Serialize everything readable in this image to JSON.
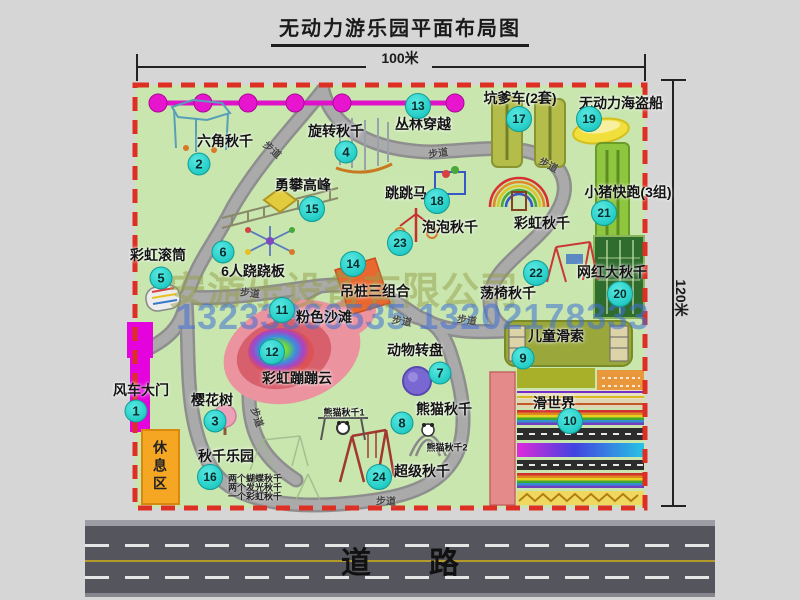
{
  "title": "无动力游乐园平面布局图",
  "dimensions": {
    "width_label": "100米",
    "height_label": "120米"
  },
  "road": {
    "label": "道路"
  },
  "watermark": {
    "company": "安游乐设备有限公司",
    "phone": "13233866535 13202178333"
  },
  "map": {
    "rest_area_label": "休息区",
    "path_label_text": "步道",
    "path_labels": [
      {
        "x": 273,
        "y": 149,
        "rot": 42
      },
      {
        "x": 438,
        "y": 152,
        "rot": -8
      },
      {
        "x": 549,
        "y": 164,
        "rot": 28
      },
      {
        "x": 250,
        "y": 292,
        "rot": 6
      },
      {
        "x": 402,
        "y": 320,
        "rot": 10
      },
      {
        "x": 467,
        "y": 319,
        "rot": 8
      },
      {
        "x": 258,
        "y": 417,
        "rot": 72
      },
      {
        "x": 386,
        "y": 500,
        "rot": 2
      }
    ],
    "attractions": [
      {
        "num": "1",
        "name": "风车大门",
        "badge": [
          136,
          411
        ],
        "label": [
          141,
          390
        ]
      },
      {
        "num": "2",
        "name": "六角秋千",
        "badge": [
          199,
          164
        ],
        "label": [
          225,
          141
        ]
      },
      {
        "num": "3",
        "name": "樱花树",
        "badge": [
          215,
          421
        ],
        "label": [
          212,
          400
        ]
      },
      {
        "num": "4",
        "name": "旋转秋千",
        "badge": [
          346,
          152
        ],
        "label": [
          336,
          131
        ]
      },
      {
        "num": "5",
        "name": "彩虹滚筒",
        "badge": [
          161,
          278
        ],
        "label": [
          158,
          255
        ]
      },
      {
        "num": "6",
        "name": "6人跷跷板",
        "badge": [
          223,
          252
        ],
        "label": [
          253,
          271
        ]
      },
      {
        "num": "7",
        "name": "动物转盘",
        "badge": [
          440,
          373
        ],
        "label": [
          415,
          350
        ]
      },
      {
        "num": "8",
        "name": "熊猫秋千",
        "badge": [
          402,
          423
        ],
        "label": [
          444,
          409
        ]
      },
      {
        "num": "9",
        "name": "儿童滑索",
        "badge": [
          523,
          358
        ],
        "label": [
          556,
          336
        ]
      },
      {
        "num": "10",
        "name": "滑世界",
        "badge": [
          570,
          421
        ],
        "label": [
          554,
          403
        ]
      },
      {
        "num": "11",
        "name": "粉色沙滩",
        "badge": [
          282,
          310
        ],
        "label": [
          324,
          317
        ]
      },
      {
        "num": "12",
        "name": "彩虹蹦蹦云",
        "badge": [
          272,
          352
        ],
        "label": [
          297,
          378
        ]
      },
      {
        "num": "13",
        "name": "丛林穿越",
        "badge": [
          418,
          106
        ],
        "label": [
          423,
          124
        ]
      },
      {
        "num": "14",
        "name": "吊桩三组合",
        "badge": [
          353,
          264
        ],
        "label": [
          375,
          291
        ]
      },
      {
        "num": "15",
        "name": "勇攀高峰",
        "badge": [
          312,
          209
        ],
        "label": [
          303,
          185
        ]
      },
      {
        "num": "16",
        "name": "秋千乐园",
        "badge": [
          210,
          477
        ],
        "label": [
          226,
          456
        ]
      },
      {
        "num": "17",
        "name": "坑爹车(2套)",
        "badge": [
          519,
          119
        ],
        "label": [
          520,
          98
        ]
      },
      {
        "num": "18",
        "name": "跳跳马",
        "badge": [
          437,
          201
        ],
        "label": [
          406,
          193
        ]
      },
      {
        "num": "19",
        "name": "无动力海盗船",
        "badge": [
          589,
          119
        ],
        "label": [
          621,
          103
        ]
      },
      {
        "num": "20",
        "name": "网红大秋千",
        "badge": [
          620,
          294
        ],
        "label": [
          612,
          272
        ]
      },
      {
        "num": "21",
        "name": "小猪快跑(3组)",
        "badge": [
          604,
          213
        ],
        "label": [
          628,
          192
        ]
      },
      {
        "num": "22",
        "name": "荡椅秋千",
        "badge": [
          536,
          273
        ],
        "label": [
          508,
          293
        ]
      },
      {
        "num": "23",
        "name": "泡泡秋千",
        "badge": [
          400,
          243
        ],
        "label": [
          450,
          227
        ]
      },
      {
        "num": "24",
        "name": "超级秋千",
        "badge": [
          379,
          477
        ],
        "label": [
          422,
          471
        ]
      }
    ],
    "extra_labels": [
      {
        "text": "彩虹秋千",
        "x": 542,
        "y": 223,
        "size": 14
      },
      {
        "text": "熊猫秋千1",
        "x": 344,
        "y": 412,
        "size": 9
      },
      {
        "text": "熊猫秋千2",
        "x": 447,
        "y": 447,
        "size": 9
      }
    ],
    "swing_sublist": {
      "x": 228,
      "lines": [
        {
          "text": "两个蝴蝶秋千",
          "y": 478
        },
        {
          "text": "两个发光秋千",
          "y": 487
        },
        {
          "text": "一个彩虹秋千",
          "y": 496
        }
      ]
    }
  }
}
